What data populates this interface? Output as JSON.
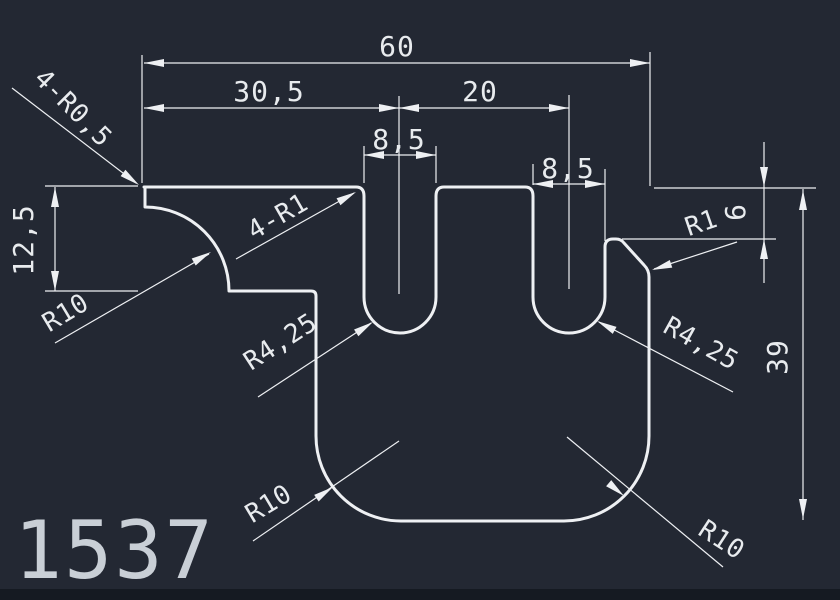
{
  "part_number": "1537",
  "colors": {
    "background": "#232833",
    "bottom_bar": "#151a22",
    "line": "#eef0f3",
    "text": "#e8ebee",
    "title": "#c9cfd6"
  },
  "dimensions": {
    "total_width": "60",
    "slot1_center_offset": "30,5",
    "slot_center_spacing": "20",
    "slot1_width": "8,5",
    "slot2_width": "8,5",
    "left_step_depth": "12,5",
    "right_shoulder_drop": "6",
    "total_height": "39"
  },
  "radius_labels": {
    "tip_corners": "4-R0,5",
    "slot_top_fillets": "4-R1",
    "left_cove": "R10",
    "slot1_bottom": "R4,25",
    "slot2_bottom": "R4,25",
    "right_shoulder_fillet": "R1",
    "bottom_left_corner": "R10",
    "bottom_right_corner": "R10"
  }
}
